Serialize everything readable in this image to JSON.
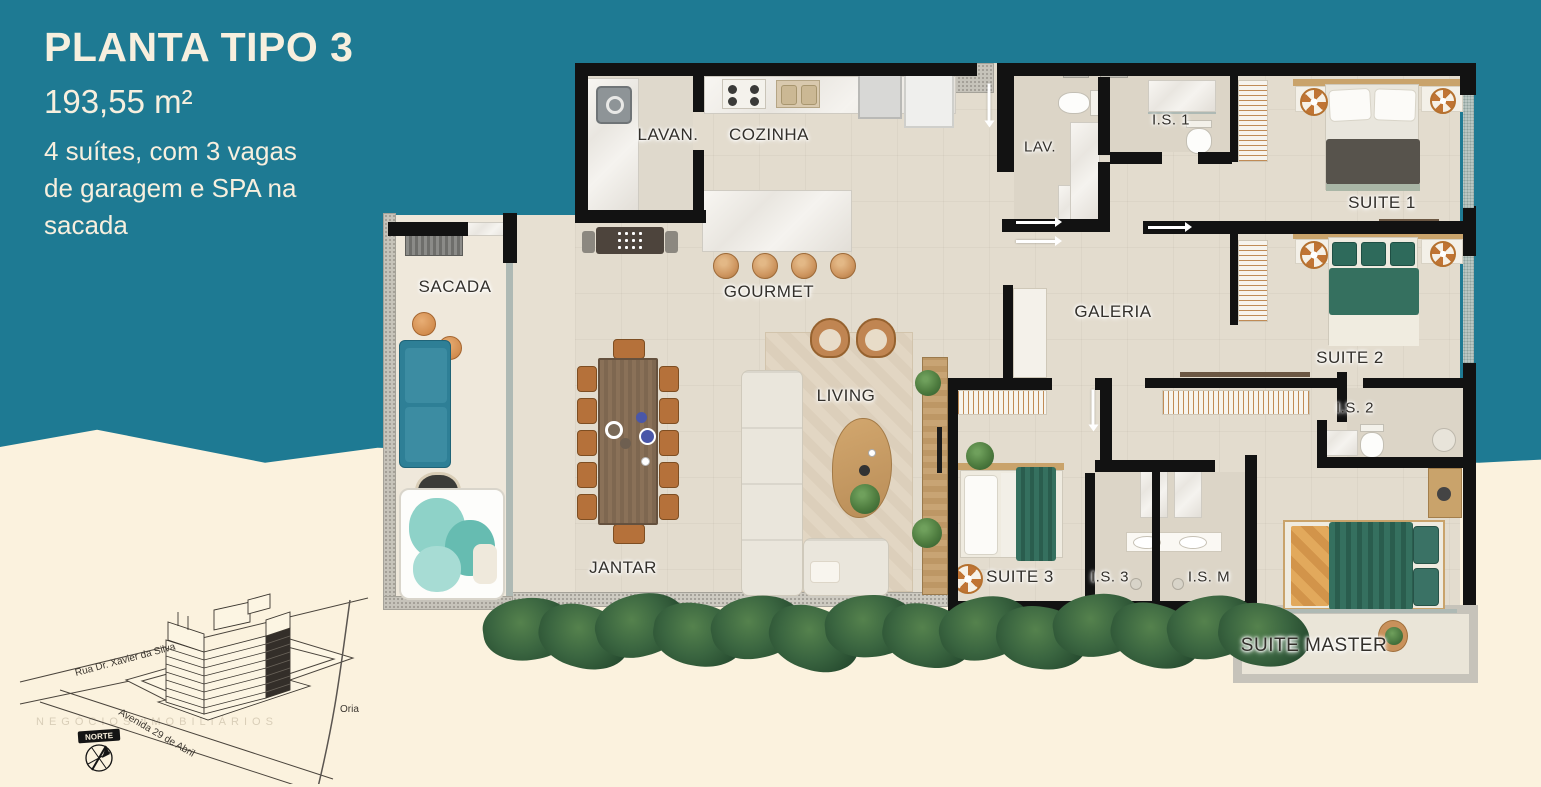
{
  "title_block": {
    "title": "PLANTA TIPO 3",
    "area": "193,55 m²",
    "description_lines": [
      "4 suítes, com 3 vagas",
      "de garagem e SPA na",
      "sacada"
    ]
  },
  "rooms": [
    {
      "id": "lavanderia",
      "label": "LAVAN."
    },
    {
      "id": "cozinha",
      "label": "COZINHA"
    },
    {
      "id": "lavabo",
      "label": "LAV."
    },
    {
      "id": "is1",
      "label": "I.S. 1"
    },
    {
      "id": "suite1",
      "label": "SUITE 1"
    },
    {
      "id": "sacada",
      "label": "SACADA"
    },
    {
      "id": "gourmet",
      "label": "GOURMET"
    },
    {
      "id": "galeria",
      "label": "GALERIA"
    },
    {
      "id": "suite2",
      "label": "SUITE 2"
    },
    {
      "id": "living",
      "label": "LIVING"
    },
    {
      "id": "is2",
      "label": "I.S. 2"
    },
    {
      "id": "jantar",
      "label": "JANTAR"
    },
    {
      "id": "suite3",
      "label": "SUITE 3"
    },
    {
      "id": "is3",
      "label": "I.S. 3"
    },
    {
      "id": "ism",
      "label": "I.S. M"
    },
    {
      "id": "suite_master",
      "label": "SUITE MASTER"
    }
  ],
  "map": {
    "street_1": "Rua Dr. Xavier da Silva",
    "street_2": "Avenida 29 de Abril",
    "compass_label": "NORTE",
    "river_label": "Oria"
  },
  "watermark": "NEGÓCIOS IMOBILIÁRIOS",
  "colors": {
    "teal_bg": "#1E7A93",
    "cream_bg": "#FBF2DE",
    "title_text": "#F7EFDE",
    "wall": "#121212",
    "floor_main": "#E3DCCE",
    "floor_sacada": "#EFE8DB",
    "wood_accent": "#C9905C",
    "bed_green": "#35705F",
    "sofa_teal": "#2E7F96",
    "fan_orange": "#C07434"
  }
}
